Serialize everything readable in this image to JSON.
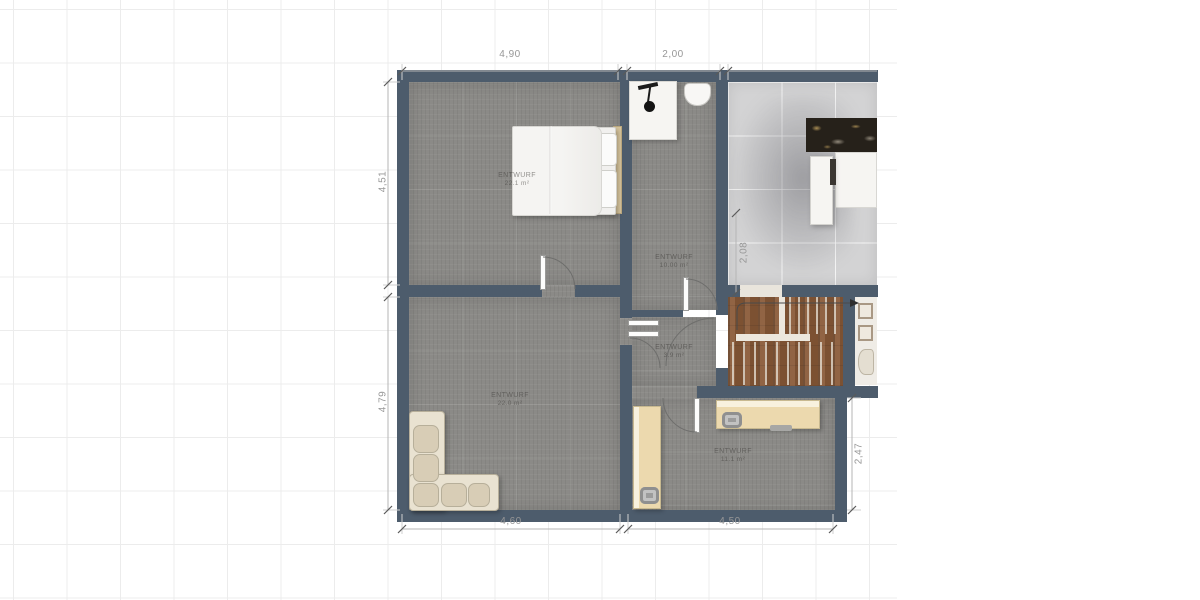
{
  "plan": {
    "title": "floor-plan",
    "dimensions": {
      "top": [
        "4,90",
        "2,00"
      ],
      "left": [
        "4,51",
        "4,79"
      ],
      "bottom": [
        "4,60",
        "4,50"
      ],
      "right_inner": "2,08",
      "right_outer": "2,47"
    },
    "rooms": [
      {
        "id": "bedroom",
        "label": "ENTWURF",
        "area": "22.1 m²"
      },
      {
        "id": "bathroom",
        "label": "ENTWURF",
        "area": "10.00 m²"
      },
      {
        "id": "hallway",
        "label": "ENTWURF",
        "area": "3.9 m²"
      },
      {
        "id": "living",
        "label": "ENTWURF",
        "area": "22.0 m²"
      },
      {
        "id": "office",
        "label": "ENTWURF",
        "area": "11.1 m²"
      }
    ],
    "colors": {
      "wall": "#4d5c6c",
      "carpet": "#8b8a87",
      "kitchen": "#d3d3d4",
      "wood": "#8a5a38",
      "cream": "#ecd9ae"
    }
  }
}
